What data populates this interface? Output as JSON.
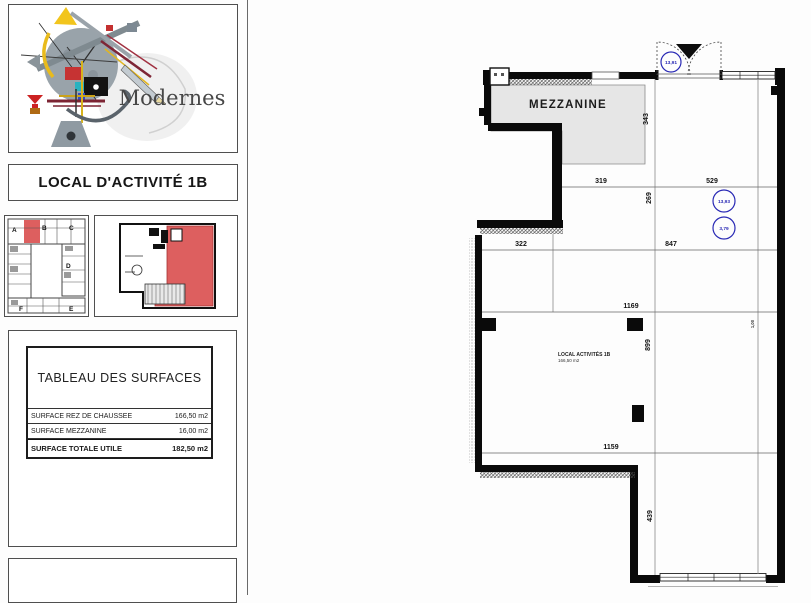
{
  "sidebar": {
    "brand": "Modernes",
    "title": "LOCAL D'ACTIVITÉ 1B",
    "thumbs": {
      "site_letters": [
        "A",
        "B",
        "C",
        "D",
        "E",
        "F"
      ]
    },
    "surface_table": {
      "title": "TABLEAU DES SURFACES",
      "rows": [
        {
          "label": "SURFACE REZ DE CHAUSSEE",
          "value": "166,50 m2"
        },
        {
          "label": "SURFACE MEZZANINE",
          "value": "16,00 m2"
        }
      ],
      "total_label": "SURFACE TOTALE UTILE",
      "total_value": "182,50 m2"
    }
  },
  "plan": {
    "mezzanine_label": "MEZZANINE",
    "room": {
      "name": "LOCAL ACTIVITÉS 1B",
      "area": "166,50 m2"
    },
    "levels": {
      "door": "13,91",
      "upper": "13,93",
      "lower": "3,79"
    },
    "dims": {
      "v343": "343",
      "h319": "319",
      "h529": "529",
      "v269": "269",
      "h322": "322",
      "h847": "847",
      "h1169": "1169",
      "v899": "899",
      "h1159": "1159",
      "v439": "439",
      "small": "1,00"
    },
    "colors": {
      "wall": "#0a0a0a",
      "mezzanine_fill": "#e6e6e6",
      "level_blue": "#2a2ab5",
      "highlight_red": "#dd5f5f"
    }
  }
}
